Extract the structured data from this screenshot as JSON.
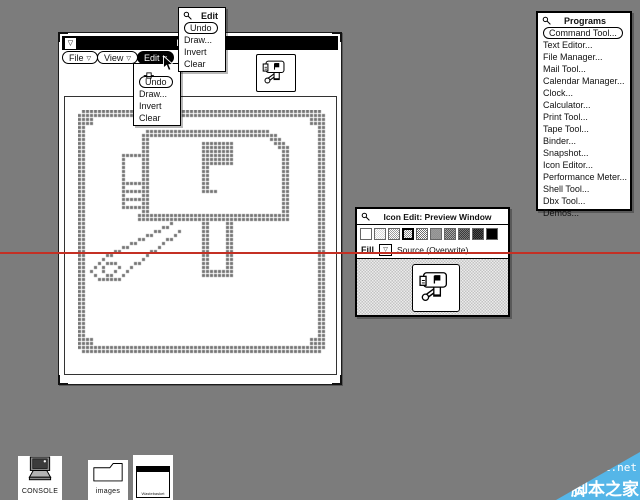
{
  "desktop": {
    "bg_color": "#7c7c7c"
  },
  "annotation": {
    "red_line_color": "#c43024",
    "red_line_y": 252
  },
  "watermark": {
    "site": "jb51.net",
    "site_name": "脚本之家",
    "bg_color": "#55b6e8"
  },
  "editor_window": {
    "title": "Icon Editor",
    "window_menu_glyph": "▽",
    "menu_buttons": [
      {
        "label": "File",
        "glyph": "▽"
      },
      {
        "label": "View",
        "glyph": "▽"
      },
      {
        "label": "Edit",
        "glyph": "▽"
      }
    ]
  },
  "edit_dropdown": {
    "items": [
      "Undo",
      "Draw...",
      "Invert",
      "Clear"
    ],
    "default_item": "Undo"
  },
  "pinned_edit_menu": {
    "title": "Edit",
    "items": [
      "Undo",
      "Draw...",
      "Invert",
      "Clear"
    ],
    "default_item": "Undo"
  },
  "programs_menu": {
    "title": "Programs",
    "default_item": "Command Tool...",
    "items": [
      "Command Tool...",
      "Text Editor...",
      "File Manager...",
      "Mail Tool...",
      "Calendar Manager...",
      "Clock...",
      "Calculator...",
      "Print Tool...",
      "Tape Tool...",
      "Binder...",
      "Snapshot...",
      "Icon Editor...",
      "Performance Meter...",
      "Shell Tool...",
      "Dbx Tool...",
      "Demos..."
    ]
  },
  "preview_window": {
    "title": "Icon Edit: Preview Window",
    "fill_label": "Fill",
    "fill_menu_glyph": "▽",
    "mode_label": "Source (Overwrite)",
    "selected_swatch_index": 3,
    "swatches": [
      {
        "name": "white",
        "a": "#ffffff",
        "b": "#ffffff"
      },
      {
        "name": "gray-12",
        "a": "#ffffff",
        "b": "#d8d8d8"
      },
      {
        "name": "gray-25",
        "a": "#ffffff",
        "b": "#9a9a9a"
      },
      {
        "name": "gray-30",
        "a": "#ffffff",
        "b": "#8e8e8e"
      },
      {
        "name": "gray-40",
        "a": "#ffffff",
        "b": "#6a6a6a"
      },
      {
        "name": "gray-50",
        "a": "#909090",
        "b": "#9b9b9b"
      },
      {
        "name": "gray-60",
        "a": "#555555",
        "b": "#a8a8a8"
      },
      {
        "name": "gray-75",
        "a": "#3a3a3a",
        "b": "#7a7a7a"
      },
      {
        "name": "gray-85",
        "a": "#1c1c1c",
        "b": "#4a4a4a"
      },
      {
        "name": "black",
        "a": "#000000",
        "b": "#000000"
      }
    ]
  },
  "desktop_icons": {
    "console": {
      "label": "CONSOLE"
    },
    "images": {
      "label": "images"
    },
    "wastebasket": {
      "label": "Wastebasket"
    }
  },
  "pixel_art": {
    "cols": 62,
    "rows": 61,
    "cell": 4,
    "color": "#757575",
    "strokes": [
      {
        "t": "rect",
        "x0": 0,
        "y0": 0,
        "x1": 61,
        "y1": 60,
        "th": 2
      },
      {
        "t": "clear",
        "cells": [
          [
            0,
            0
          ],
          [
            61,
            0
          ],
          [
            0,
            60
          ],
          [
            61,
            60
          ]
        ]
      },
      {
        "t": "fill",
        "x0": 2,
        "y0": 2,
        "x1": 3,
        "y1": 3
      },
      {
        "t": "fill",
        "x0": 58,
        "y0": 2,
        "x1": 59,
        "y1": 3
      },
      {
        "t": "fill",
        "x0": 2,
        "y0": 57,
        "x1": 3,
        "y1": 58
      },
      {
        "t": "fill",
        "x0": 58,
        "y0": 57,
        "x1": 59,
        "y1": 58
      },
      {
        "t": "hline",
        "y": 5,
        "x0": 17,
        "x1": 47,
        "th": 2
      },
      {
        "t": "line",
        "x0": 48,
        "y0": 6,
        "x1": 51,
        "y1": 9,
        "th": 2
      },
      {
        "t": "vline",
        "x": 51,
        "y0": 9,
        "y1": 27,
        "th": 2
      },
      {
        "t": "hline",
        "y": 26,
        "x0": 15,
        "x1": 52,
        "th": 2
      },
      {
        "t": "vline",
        "x": 16,
        "y0": 6,
        "y1": 26,
        "th": 2
      },
      {
        "t": "vline",
        "x": 11,
        "y0": 11,
        "y1": 24,
        "th": 1
      },
      {
        "t": "hline",
        "y": 11,
        "x0": 11,
        "x1": 16,
        "th": 1
      },
      {
        "t": "hline",
        "y": 24,
        "x0": 11,
        "x1": 16,
        "th": 1
      },
      {
        "t": "hline",
        "y": 18,
        "x0": 12,
        "x1": 15,
        "th": 1
      },
      {
        "t": "hline",
        "y": 20,
        "x0": 12,
        "x1": 15,
        "th": 1
      },
      {
        "t": "hline",
        "y": 22,
        "x0": 12,
        "x1": 15,
        "th": 1
      },
      {
        "t": "vline",
        "x": 31,
        "y0": 8,
        "y1": 20,
        "th": 2
      },
      {
        "t": "hline",
        "y": 20,
        "x0": 31,
        "x1": 34,
        "th": 1
      },
      {
        "t": "fill",
        "x0": 33,
        "y0": 8,
        "x1": 38,
        "y1": 13
      },
      {
        "t": "vline",
        "x": 31,
        "y0": 28,
        "y1": 41,
        "th": 2
      },
      {
        "t": "vline",
        "x": 37,
        "y0": 28,
        "y1": 41,
        "th": 2
      },
      {
        "t": "fill",
        "x0": 31,
        "y0": 40,
        "x1": 38,
        "y1": 41
      },
      {
        "t": "line",
        "x0": 23,
        "y0": 28,
        "x1": 6,
        "y1": 37,
        "th": 1
      },
      {
        "t": "line",
        "x0": 25,
        "y0": 30,
        "x1": 13,
        "y1": 39,
        "th": 1
      },
      {
        "t": "line",
        "x0": 6,
        "y0": 37,
        "x1": 3,
        "y1": 40,
        "th": 1
      },
      {
        "t": "line",
        "x0": 3,
        "y0": 40,
        "x1": 5,
        "y1": 42,
        "th": 1
      },
      {
        "t": "line",
        "x0": 5,
        "y0": 42,
        "x1": 10,
        "y1": 42,
        "th": 1
      },
      {
        "t": "line",
        "x0": 10,
        "y0": 42,
        "x1": 13,
        "y1": 39,
        "th": 1
      },
      {
        "t": "line",
        "x0": 7,
        "y0": 38,
        "x1": 6,
        "y1": 40,
        "th": 1
      },
      {
        "t": "line",
        "x0": 6,
        "y0": 40,
        "x1": 8,
        "y1": 41,
        "th": 1
      },
      {
        "t": "line",
        "x0": 8,
        "y0": 41,
        "x1": 10,
        "y1": 39,
        "th": 1
      },
      {
        "t": "line",
        "x0": 10,
        "y0": 39,
        "x1": 8,
        "y1": 38,
        "th": 1
      }
    ]
  }
}
